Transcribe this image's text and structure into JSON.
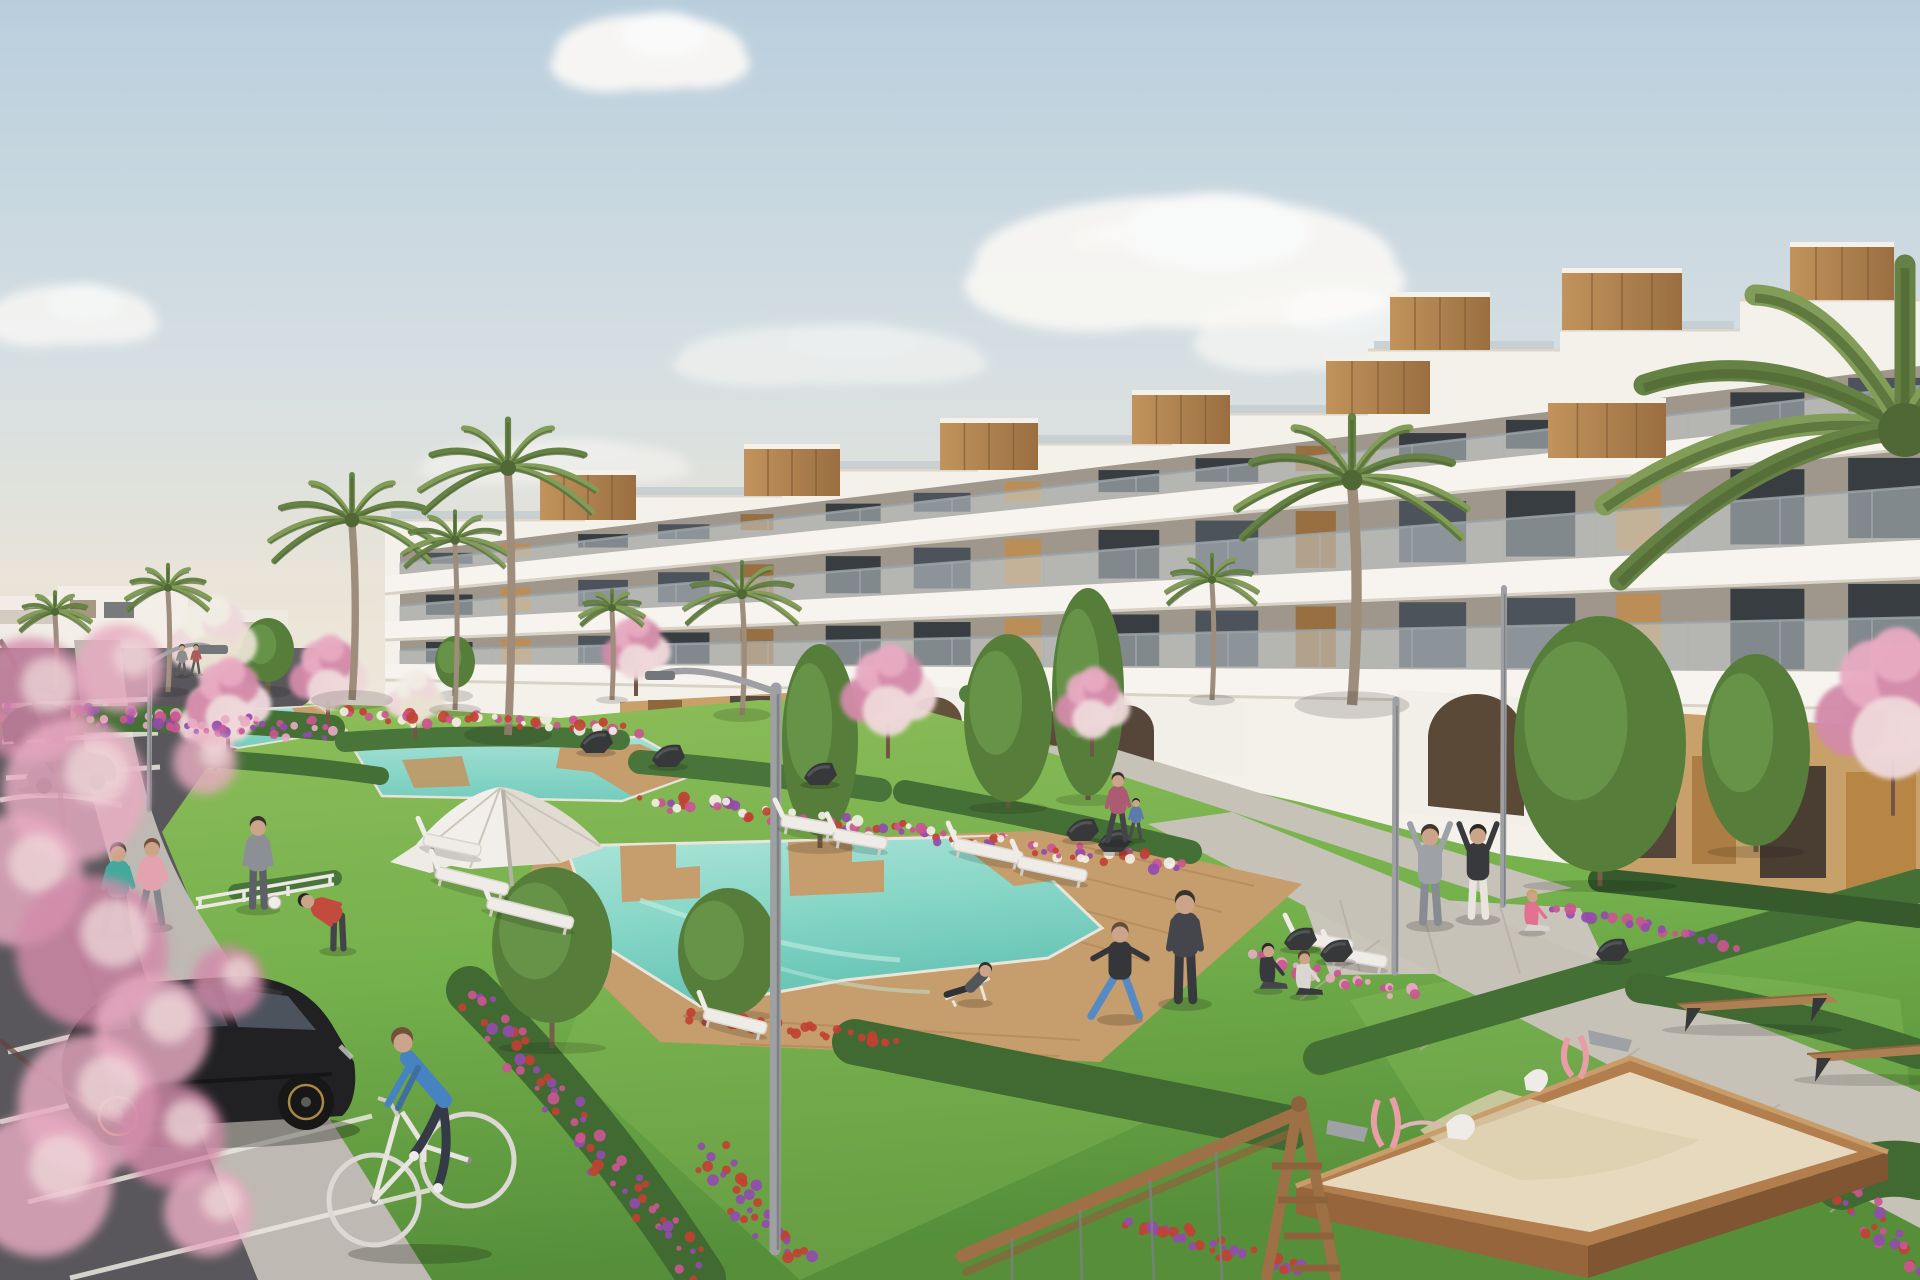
{
  "scene": {
    "title": "Residential complex exterior rendering",
    "description": "Architectural rendering of a modern white terraced apartment complex with rooftop wood-clad terraces, communal turquoise pools with timber decks, lawns, flower beds, pink blossom and palm trees, a parking lot with a black hatchback, a cyclist, people exercising, benches and a children's sandbox playground."
  },
  "palette": {
    "skyTop": "#b7cedf",
    "skyMid": "#d3dfe4",
    "skyHorizon": "#eee8dc",
    "cloud": "#fbfaf8",
    "buildingWhite": "#f5f3ee",
    "buildingShade": "#e4dfd6",
    "slab": "#f8f6f2",
    "slabShadow": "#d9d3c8",
    "wood": "#b5archive",
    "glass": "#454c55",
    "glassDark": "#2f353c",
    "balGlass": "#ccd5d9",
    "balRail": "#97a1a6",
    "lawn": "#76b14b",
    "lawnLight": "#8cc25d",
    "lawnDark": "#4d8a33",
    "hedge": "#3c6b2f",
    "hedgeDark": "#2d5424",
    "pool": "#63c6b8",
    "poolLight": "#ace8dd",
    "deck": "#c49a68",
    "deckLine": "#a87e4e",
    "asphalt": "#525156",
    "sidewalk": "#bcb8b1",
    "path": "#c6c1b8",
    "lineWhite": "#eceae4",
    "sand": "#e6dabe",
    "sandShade": "#d6c8a8",
    "boxWood": "#b07a48",
    "boxWoodDark": "#8a5a30",
    "woodPanel": "#b98a52",
    "woodPanelDark": "#936a3a",
    "blossom": "#e8a9c2",
    "blossomDeep": "#d287a8",
    "blossomPale": "#f0d9dd",
    "palm": "#5f7d3e",
    "palmLight": "#7d9a52",
    "palmDark": "#47632e",
    "trunk": "#998a76",
    "flowerRed": "#c0392b",
    "flowerMagenta": "#c94f8e",
    "flowerPurple": "#8e44ad",
    "flowerWhite": "#f2f0e6",
    "metal": "#9a9ea2",
    "darkMetal": "#3a3d41",
    "skin": "#caa287",
    "white": "#f0eeea",
    "tanWall": "#c79d66",
    "archDark": "#5d4a35",
    "carBlack": "#17181c"
  },
  "sky": {
    "clouds": [
      {
        "x": 650,
        "y": 52,
        "rx": 95,
        "ry": 38,
        "o": 0.95
      },
      {
        "x": 1185,
        "y": 262,
        "rx": 210,
        "ry": 66,
        "o": 0.9
      },
      {
        "x": 1320,
        "y": 330,
        "rx": 120,
        "ry": 40,
        "o": 0.7
      },
      {
        "x": 72,
        "y": 315,
        "rx": 82,
        "ry": 30,
        "o": 0.8
      },
      {
        "x": 830,
        "y": 355,
        "rx": 150,
        "ry": 30,
        "o": 0.55
      },
      {
        "x": 555,
        "y": 462,
        "rx": 130,
        "ry": 22,
        "o": 0.5
      },
      {
        "x": 1105,
        "y": 238,
        "rx": 32,
        "ry": 12,
        "o": 0.6
      }
    ]
  },
  "vegetation": {
    "palms": [
      {
        "cx": 55,
        "cy": 612,
        "r": 36,
        "baseY": 690,
        "layer": "back"
      },
      {
        "cx": 168,
        "cy": 588,
        "r": 42,
        "baseY": 692,
        "layer": "back"
      },
      {
        "cx": 352,
        "cy": 520,
        "r": 82,
        "baseY": 700,
        "layer": "back"
      },
      {
        "cx": 455,
        "cy": 540,
        "r": 52,
        "baseY": 710,
        "layer": "back"
      },
      {
        "cx": 508,
        "cy": 468,
        "r": 88,
        "baseY": 735,
        "layer": "back"
      },
      {
        "cx": 612,
        "cy": 608,
        "r": 32,
        "baseY": 700,
        "layer": "back"
      },
      {
        "cx": 742,
        "cy": 594,
        "r": 58,
        "baseY": 715,
        "layer": "back"
      },
      {
        "cx": 1352,
        "cy": 480,
        "r": 115,
        "baseY": 705,
        "layer": "back"
      },
      {
        "cx": 1212,
        "cy": 580,
        "r": 46,
        "baseY": 700,
        "layer": "back"
      },
      {
        "cx": 1905,
        "cy": 430,
        "r": 300,
        "baseY": 1280,
        "layer": "front",
        "noTrunk": true
      }
    ],
    "pinkTrees": [
      {
        "cx": 228,
        "cy": 702,
        "r": 50
      },
      {
        "cx": 328,
        "cy": 676,
        "r": 46
      },
      {
        "cx": 636,
        "cy": 650,
        "r": 40
      },
      {
        "cx": 888,
        "cy": 694,
        "r": 56
      },
      {
        "cx": 1092,
        "cy": 706,
        "r": 44
      },
      {
        "cx": 1893,
        "cy": 710,
        "r": 92
      }
    ],
    "paleTrees": [
      {
        "cx": 212,
        "cy": 642,
        "r": 52
      },
      {
        "cx": 215,
        "cy": 720,
        "r": 44
      },
      {
        "cx": 415,
        "cy": 700,
        "r": 34
      }
    ],
    "greenTrees": [
      {
        "cx": 268,
        "cy": 650,
        "rx": 26,
        "ry": 32,
        "baseY": 692
      },
      {
        "cx": 455,
        "cy": 662,
        "rx": 20,
        "ry": 26,
        "baseY": 696
      },
      {
        "cx": 552,
        "cy": 945,
        "rx": 60,
        "ry": 78,
        "baseY": 1048
      },
      {
        "cx": 728,
        "cy": 952,
        "rx": 50,
        "ry": 64,
        "baseY": 1016
      },
      {
        "cx": 820,
        "cy": 740,
        "rx": 38,
        "ry": 96,
        "baseY": 848
      },
      {
        "cx": 1008,
        "cy": 718,
        "rx": 44,
        "ry": 84,
        "baseY": 808
      },
      {
        "cx": 1088,
        "cy": 692,
        "rx": 36,
        "ry": 104,
        "baseY": 800
      },
      {
        "cx": 1600,
        "cy": 744,
        "rx": 86,
        "ry": 128,
        "baseY": 886
      },
      {
        "cx": 1756,
        "cy": 750,
        "rx": 54,
        "ry": 96,
        "baseY": 852
      }
    ],
    "flowerBeds": [
      {
        "x0": 4,
        "y0": 712,
        "x1": 330,
        "y1": 730,
        "n": 80,
        "spread": 16,
        "colors": [
          "flowerMagenta",
          "flowerPurple",
          "blossom"
        ]
      },
      {
        "x0": 340,
        "y0": 716,
        "x1": 640,
        "y1": 728,
        "n": 44,
        "spread": 10,
        "colors": [
          "flowerRed",
          "flowerMagenta",
          "flowerWhite"
        ]
      },
      {
        "x0": 652,
        "y0": 800,
        "x1": 1185,
        "y1": 866,
        "n": 100,
        "spread": 14,
        "colors": [
          "flowerRed",
          "flowerMagenta",
          "flowerPurple",
          "flowerWhite"
        ]
      },
      {
        "x0": 470,
        "y0": 992,
        "x1": 700,
        "y1": 1274,
        "n": 66,
        "spread": 20,
        "colors": [
          "flowerMagenta",
          "flowerPurple",
          "flowerRed"
        ]
      },
      {
        "x0": 706,
        "y0": 1150,
        "x1": 800,
        "y1": 1270,
        "n": 34,
        "spread": 18,
        "colors": [
          "flowerPurple",
          "flowerRed"
        ]
      },
      {
        "x0": 690,
        "y0": 1016,
        "x1": 905,
        "y1": 1042,
        "n": 30,
        "spread": 8,
        "colors": [
          "flowerRed"
        ]
      },
      {
        "x0": 1250,
        "y0": 958,
        "x1": 1425,
        "y1": 996,
        "n": 26,
        "spread": 10,
        "colors": [
          "blossom",
          "flowerMagenta"
        ]
      },
      {
        "x0": 1558,
        "y0": 906,
        "x1": 1735,
        "y1": 946,
        "n": 26,
        "spread": 9,
        "colors": [
          "flowerPurple",
          "flowerMagenta"
        ]
      },
      {
        "x0": 1130,
        "y0": 1218,
        "x1": 1300,
        "y1": 1272,
        "n": 34,
        "spread": 14,
        "colors": [
          "flowerRed",
          "flowerPurple"
        ]
      },
      {
        "x0": 1808,
        "y0": 1152,
        "x1": 1916,
        "y1": 1268,
        "n": 34,
        "spread": 18,
        "colors": [
          "flowerPurple",
          "flowerRed",
          "flowerMagenta"
        ]
      }
    ],
    "foregroundBlossoms": [
      {
        "x": 30,
        "y": 700,
        "r": 62
      },
      {
        "x": 75,
        "y": 790,
        "r": 72
      },
      {
        "x": 18,
        "y": 880,
        "r": 66
      },
      {
        "x": 92,
        "y": 952,
        "r": 76
      },
      {
        "x": 152,
        "y": 1032,
        "r": 58
      },
      {
        "x": 88,
        "y": 1104,
        "r": 70
      },
      {
        "x": 172,
        "y": 1136,
        "r": 52
      },
      {
        "x": 40,
        "y": 1185,
        "r": 72
      },
      {
        "x": 205,
        "y": 762,
        "r": 32
      },
      {
        "x": 228,
        "y": 982,
        "r": 36
      },
      {
        "x": 208,
        "y": 1212,
        "r": 44
      },
      {
        "x": 120,
        "y": 668,
        "r": 44
      }
    ]
  },
  "furniture": {
    "loungers": [
      {
        "x": 452,
        "y": 846,
        "w": 58,
        "rot": 12
      },
      {
        "x": 472,
        "y": 882,
        "w": 74,
        "rot": 14
      },
      {
        "x": 530,
        "y": 914,
        "w": 88,
        "rot": 14
      },
      {
        "x": 808,
        "y": 826,
        "w": 54,
        "rot": 10
      },
      {
        "x": 860,
        "y": 840,
        "w": 54,
        "rot": 10
      },
      {
        "x": 988,
        "y": 852,
        "w": 70,
        "rot": 12
      },
      {
        "x": 1052,
        "y": 870,
        "w": 70,
        "rot": 12
      },
      {
        "x": 735,
        "y": 1022,
        "w": 64,
        "rot": 14
      },
      {
        "x": 1322,
        "y": 942,
        "w": 62,
        "rot": 10
      },
      {
        "x": 1358,
        "y": 958,
        "w": 58,
        "rot": 10
      }
    ],
    "chairs": [
      {
        "x": 596,
        "y": 744
      },
      {
        "x": 668,
        "y": 758
      },
      {
        "x": 820,
        "y": 776
      },
      {
        "x": 1082,
        "y": 832
      },
      {
        "x": 1114,
        "y": 843
      },
      {
        "x": 1300,
        "y": 941
      },
      {
        "x": 1336,
        "y": 953
      },
      {
        "x": 1612,
        "y": 952
      }
    ],
    "benches": [
      {
        "x": 1752,
        "y": 1004,
        "w": 150
      },
      {
        "x": 1872,
        "y": 1054,
        "w": 130
      }
    ]
  },
  "people": [
    {
      "x": 118,
      "yF": 934,
      "h": 92,
      "pose": "walk",
      "shirt": "#3aa79b",
      "pants": "#2a2d31",
      "hair": "#3a2e26"
    },
    {
      "x": 152,
      "yF": 926,
      "h": 88,
      "pose": "walk",
      "shirt": "#e2a1ad",
      "pants": "#7d828a",
      "hair": "#6b4a33"
    },
    {
      "x": 258,
      "yF": 908,
      "h": 92,
      "pose": "stand",
      "shirt": "#878c92",
      "pants": "#565b61",
      "hair": "#2f2a26",
      "ball": true
    },
    {
      "x": 338,
      "yF": 950,
      "h": 78,
      "pose": "bend",
      "shirt": "#c04437",
      "pants": "#3a3d42",
      "hair": "#201d1b"
    },
    {
      "x": 975,
      "yF": 1002,
      "h": 74,
      "pose": "recline",
      "shirt": "#4a4e55",
      "pants": "#26292e",
      "hair": "#2f2a26"
    },
    {
      "x": 1120,
      "yF": 1018,
      "h": 96,
      "pose": "lunge",
      "shirt": "#2b2e33",
      "pants": "#4f86c6",
      "hair": "#5a4631"
    },
    {
      "x": 1185,
      "yF": 1002,
      "h": 112,
      "pose": "stand",
      "shirt": "#3c3f45",
      "pants": "#2e3136",
      "hair": "#2f2a26"
    },
    {
      "x": 1268,
      "yF": 990,
      "h": 62,
      "pose": "sit",
      "shirt": "#2e3136",
      "pants": "#3c3f45",
      "hair": "#222222"
    },
    {
      "x": 1304,
      "yF": 996,
      "h": 60,
      "pose": "sit",
      "shirt": "#d9d7d2",
      "pants": "#2e3136",
      "hair": "#4a3526"
    },
    {
      "x": 1430,
      "yF": 924,
      "h": 100,
      "pose": "armsup",
      "shirt": "#9aa0a6",
      "pants": "#828890",
      "hair": "#3a2e26"
    },
    {
      "x": 1478,
      "yF": 918,
      "h": 94,
      "pose": "armsup",
      "shirt": "#2e3135",
      "pants": "#e8e6e1",
      "hair": "#201d1b"
    },
    {
      "x": 1532,
      "yF": 932,
      "h": 56,
      "pose": "sit",
      "shirt": "#e26b8e",
      "pants": "#d8d5cf",
      "hair": "#c7a15a"
    },
    {
      "x": 1118,
      "yF": 842,
      "h": 70,
      "pose": "walk",
      "shirt": "#a8566e",
      "pants": "#3a3d42",
      "hair": "#2f2a26"
    },
    {
      "x": 1136,
      "yF": 840,
      "h": 42,
      "pose": "walk",
      "shirt": "#5577aa",
      "pants": "#444444",
      "hair": "#222222"
    },
    {
      "x": 182,
      "yF": 676,
      "h": 32,
      "pose": "walk",
      "shirt": "#888888",
      "pants": "#555555",
      "hair": "#333333"
    },
    {
      "x": 196,
      "yF": 674,
      "h": 30,
      "pose": "walk",
      "shirt": "#aa5555",
      "pants": "#555555",
      "hair": "#333333"
    }
  ],
  "lighting": {
    "lampPosts": [
      {
        "x": 775,
        "topY": 688,
        "baseY": 1250,
        "armDx": -115,
        "armDy": -14,
        "w": 11,
        "head": true
      },
      {
        "x": 149,
        "topY": 660,
        "baseY": 810,
        "armDx": 64,
        "armDy": -12,
        "w": 5,
        "head": true
      },
      {
        "x": 1503,
        "topY": 588,
        "baseY": 905,
        "armDx": 0,
        "armDy": 0,
        "w": 6,
        "head": false
      },
      {
        "x": 1395,
        "topY": 700,
        "baseY": 972,
        "armDx": 0,
        "armDy": 0,
        "w": 7,
        "head": false
      }
    ]
  },
  "building": {
    "roofBoxes": [
      {
        "x": 540,
        "y": 470,
        "w": 96,
        "h": 50
      },
      {
        "x": 744,
        "y": 444,
        "w": 96,
        "h": 52
      },
      {
        "x": 940,
        "y": 418,
        "w": 98,
        "h": 52
      },
      {
        "x": 1132,
        "y": 390,
        "w": 98,
        "h": 54
      },
      {
        "x": 1326,
        "y": 356,
        "w": 104,
        "h": 58
      },
      {
        "x": 1390,
        "y": 292,
        "w": 100,
        "h": 58
      },
      {
        "x": 1562,
        "y": 268,
        "w": 120,
        "h": 62
      },
      {
        "x": 1790,
        "y": 242,
        "w": 104,
        "h": 58
      },
      {
        "x": 1548,
        "y": 398,
        "w": 118,
        "h": 60
      }
    ]
  }
}
